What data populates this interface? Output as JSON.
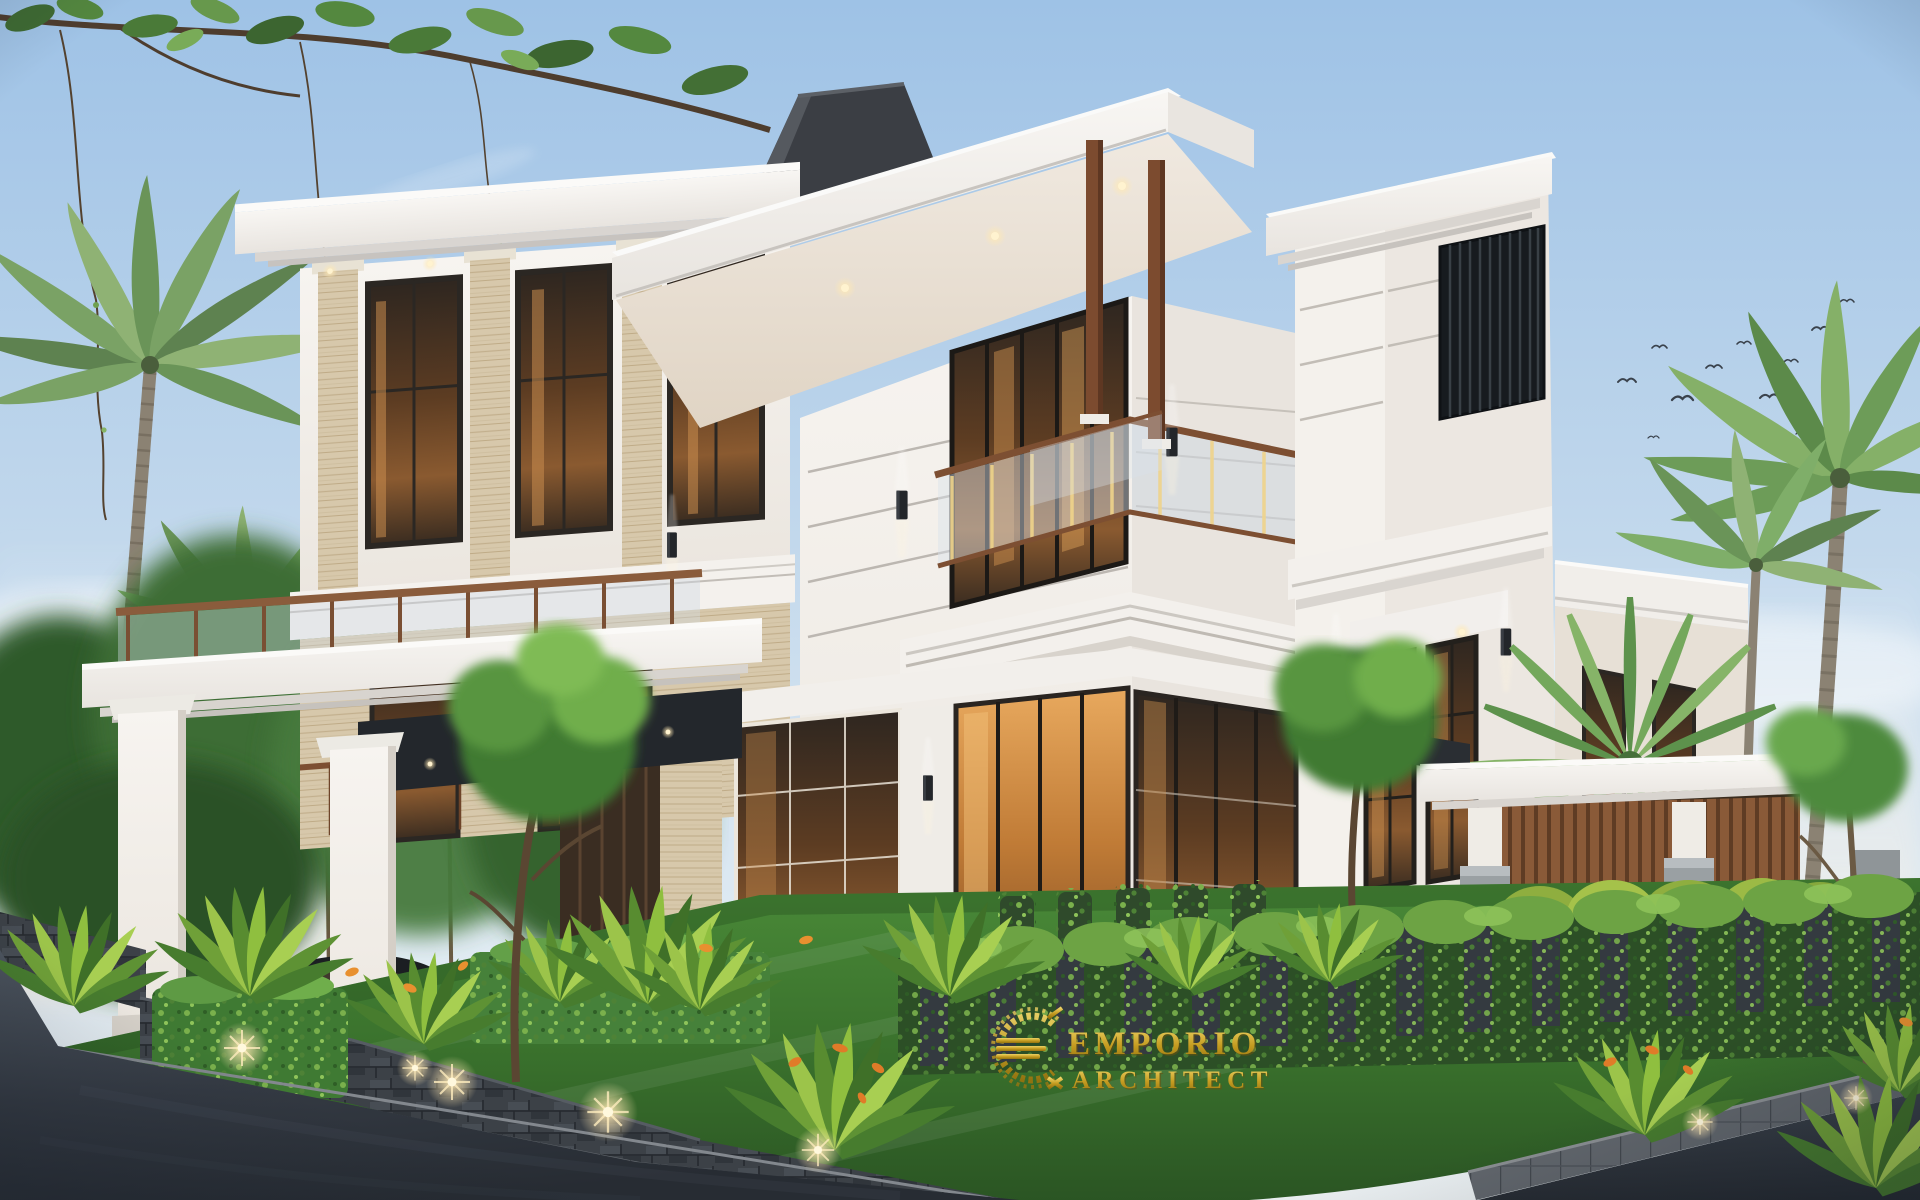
{
  "watermark": {
    "brand": "EMPORIO",
    "subbrand": "ARCHITECT",
    "emblem": "gold-laurel-wreath-with-triple-bar-monogram",
    "color": "#c9a22c"
  },
  "scene": {
    "description": "Dusk exterior render of a three-storey modern classic white villa on a corner lot with tropical landscaping, carport, pergola, lawn, stone fences and asphalt road",
    "elements": [
      "gradient-dusk-sky",
      "soft-clouds",
      "flock-of-birds",
      "overhanging-leafy-branch",
      "coconut-palms-left",
      "coconut-palms-right",
      "fan-palm",
      "background-trees",
      "three-storey-villa",
      "flat-overhang-roofs",
      "stepped-cornice-moldings",
      "travertine-pilasters",
      "dark-framed-glass-windows",
      "warm-interior-glow",
      "glass-and-wood-balconies",
      "wall-sconces",
      "soffit-downlights",
      "rooftop-terrace",
      "wood-posts",
      "dark-louver-accent-panel",
      "carport",
      "dark-sedan-car",
      "entry-glass-doors",
      "right-pergola",
      "wood-louver-screen",
      "stone-pillar-bases",
      "vine-covered-fence",
      "stone-planter-walls",
      "box-hedges",
      "tropical-plants",
      "orange-flowers",
      "garden-accent-lights",
      "front-lawn",
      "stone-curb",
      "asphalt-road",
      "emporio-architect-watermark"
    ]
  },
  "palette": {
    "sky_top": "#9ec2e6",
    "sky_horizon": "#e9eef0",
    "wall_white": "#f4f1ed",
    "wall_shadow": "#e7e2dc",
    "travertine": "#d7c8ab",
    "wood_brown": "#8a5a38",
    "glass_warm": "#8a5a30",
    "glass_cool": "#d8e1e8",
    "lawn_green": "#3f7d32",
    "foliage_dark": "#2e5a2c",
    "foliage_light": "#8fc45a",
    "stone_fence": "#3c4147",
    "asphalt": "#343a43",
    "gold": "#c9a22c"
  }
}
